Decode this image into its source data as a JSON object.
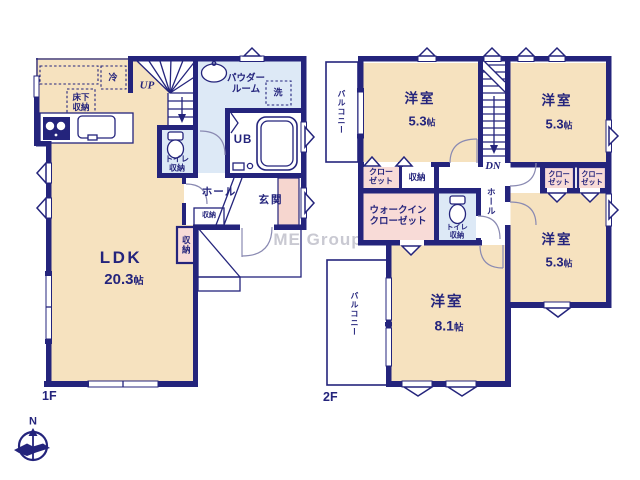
{
  "colors": {
    "wall": "#24247c",
    "room_cream": "#f6e2bf",
    "wet_blue": "#dde9f6",
    "closet_pink": "#f8dbd7",
    "cabinet_pink": "#f6d6cf",
    "text": "#24247c",
    "watermark": "#c9c9d2"
  },
  "watermark": {
    "text": "ME Group"
  },
  "compass": {
    "north": "N"
  },
  "floor1": {
    "label": "1F",
    "rooms": {
      "ldk": {
        "name": "LDK",
        "size_num": "20.3",
        "size_unit": "帖"
      },
      "up": "UP",
      "fridge": "冷",
      "underfloor": "床下\n収納",
      "powder": "パウダー\nルーム",
      "washer": "洗",
      "bath": "UB",
      "toilet": "トイレ\n収納",
      "hall": "ホール",
      "entrance": "玄関",
      "hall_storage": "収納",
      "ldk_storage": "収納"
    }
  },
  "floor2": {
    "label": "2F",
    "rooms": {
      "balcony_top": "バルコニー",
      "balcony_bottom": "バルコニー",
      "bed1": {
        "name": "洋室",
        "size_num": "5.3",
        "size_unit": "帖"
      },
      "bed2": {
        "name": "洋室",
        "size_num": "5.3",
        "size_unit": "帖"
      },
      "bed3": {
        "name": "洋室",
        "size_num": "5.3",
        "size_unit": "帖"
      },
      "bed4": {
        "name": "洋室",
        "size_num": "8.1",
        "size_unit": "帖"
      },
      "dn": "DN",
      "closet_a": "クロー\nゼット",
      "storage": "収納",
      "closet_b": "クロー\nゼット",
      "closet_c": "クロー\nゼット",
      "walkin": "ウォークイン\nクローゼット",
      "toilet": "トイレ\n収納",
      "hall": "ホール"
    }
  }
}
